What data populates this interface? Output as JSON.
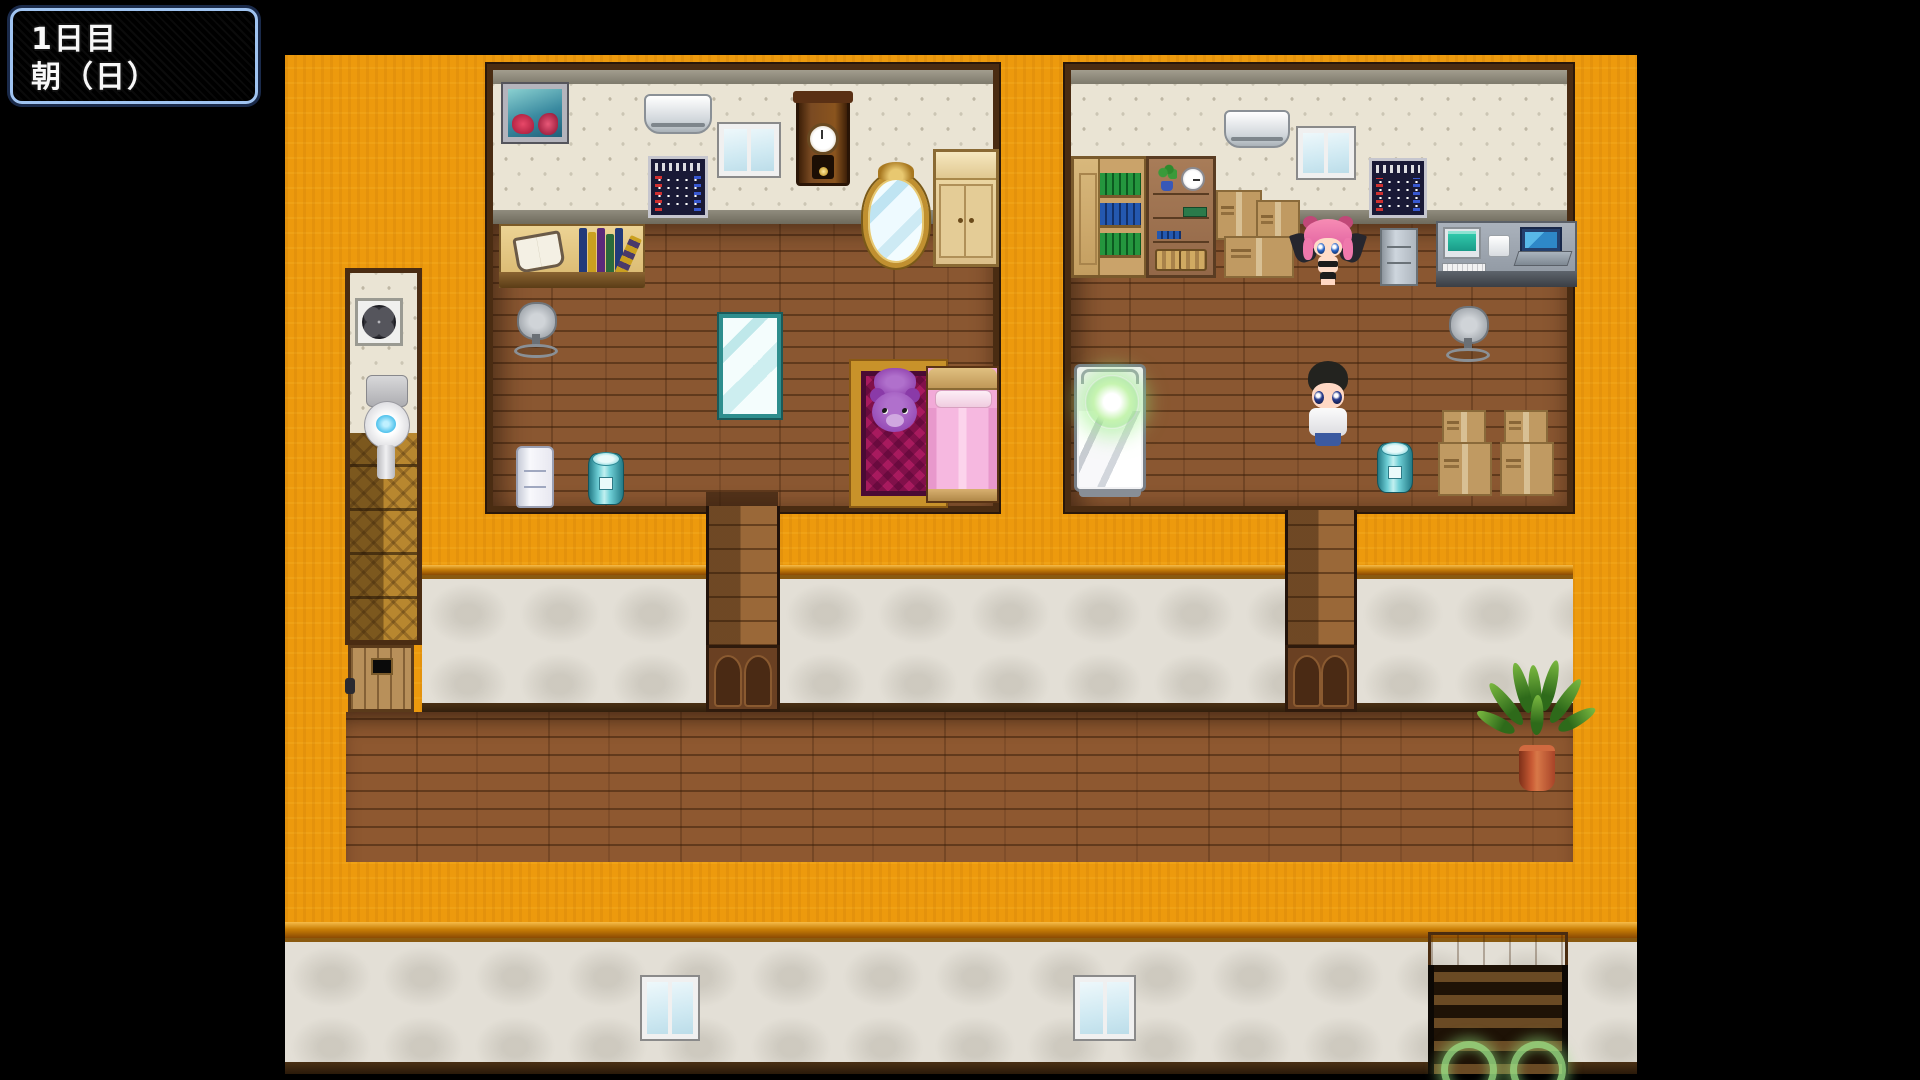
{
  "hud": {
    "line1": "1日目",
    "line2": "朝（日）"
  },
  "palette": {
    "letterbox": "#000000",
    "roof_orange": "#ED9A0D",
    "room_floor_wood": "#8A5731",
    "corridor_wall_white": "#E3DFD6",
    "wallpaper_cream": "#EAE4D4",
    "hud_border_blue": "#9FC3F0",
    "hud_body_dark": "#1C1C20",
    "glow_green": "#9BE487",
    "bed_pink": "#F2AAD8",
    "teal_drum": "#6ECFD6",
    "teddy_purple": "#9448B4",
    "rug_magenta": "#A81A5E"
  },
  "scene": {
    "rooms": [
      {
        "name": "left-bedroom",
        "objects": [
          "painting",
          "air-conditioner",
          "window",
          "calendar",
          "wall-clock",
          "ornate-mirror",
          "wardrobe",
          "study-desk",
          "open-book",
          "book-stack",
          "office-chair",
          "floor-mirror",
          "rug",
          "teddy-bear",
          "pink-bed",
          "white-cabinet",
          "teal-drum"
        ]
      },
      {
        "name": "right-bedroom",
        "objects": [
          "cabinet-bookshelf",
          "shelf-unit",
          "mini-plant",
          "round-clock",
          "wicker-baskets",
          "cardboard-boxes",
          "air-conditioner",
          "window",
          "calendar",
          "demon-girl-character",
          "filing-cabinet",
          "computer-desk",
          "monitor",
          "keyboard",
          "pc-box",
          "laptop",
          "office-chair",
          "bed-with-glow-orb",
          "boy-character",
          "teal-drum",
          "box-stacks"
        ]
      },
      {
        "name": "bathroom",
        "objects": [
          "ventilation-fan",
          "toilet",
          "tile-floor",
          "wooden-door"
        ]
      },
      {
        "name": "hallway",
        "objects": [
          "left-paneled-door",
          "right-paneled-door",
          "potted-plant"
        ]
      },
      {
        "name": "lower-corridor",
        "objects": [
          "small-window-left",
          "small-window-right",
          "stair-hatch",
          "glow-ring-left",
          "glow-ring-right"
        ]
      }
    ],
    "characters": [
      {
        "name": "demon-girl",
        "hair": "pink",
        "features": "horn buns, dark wings, black bikini"
      },
      {
        "name": "boy",
        "hair": "black",
        "features": "white shirt, blue pants"
      }
    ]
  }
}
